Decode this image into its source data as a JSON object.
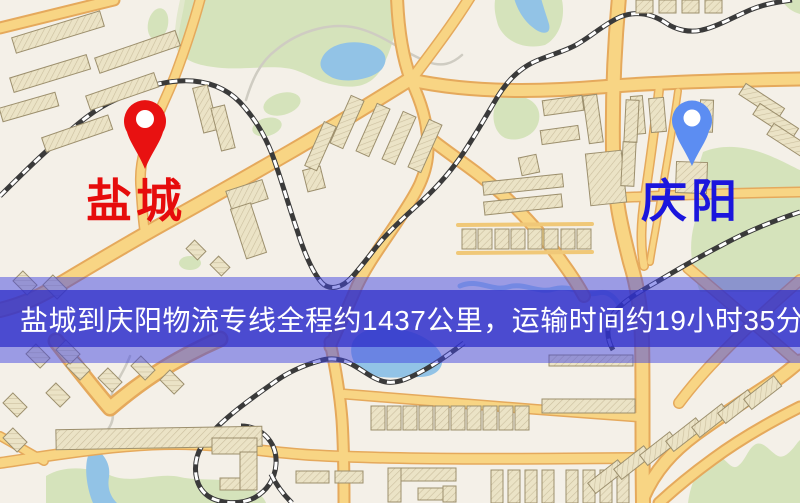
{
  "map": {
    "banner": {
      "text": "盐城到庆阳物流专线全程约1437公里，运输时间约19小时35分钟."
    },
    "markers": [
      {
        "id": "yancheng",
        "label": "盐城",
        "pin_color": "#e81111",
        "label_color": "#e60c0c"
      },
      {
        "id": "qingyang",
        "label": "庆阳",
        "pin_color": "#5c8df2",
        "label_color": "#1b16dd"
      }
    ],
    "colors": {
      "background": "#f4f0e8",
      "park_green": "#d5e3bb",
      "water_blue": "#92c3e6",
      "road_fill": "#f8d584",
      "road_casing": "#e5a95c",
      "building_fill": "#ebe3c6",
      "building_stroke": "#9c8f6d",
      "railway_dark": "#3a3a3a",
      "railway_light": "#ffffff",
      "banner_outer": "rgba(66,70,224,0.5)",
      "banner_inner": "rgba(45,45,200,0.72)",
      "banner_text": "#ffffff"
    }
  }
}
